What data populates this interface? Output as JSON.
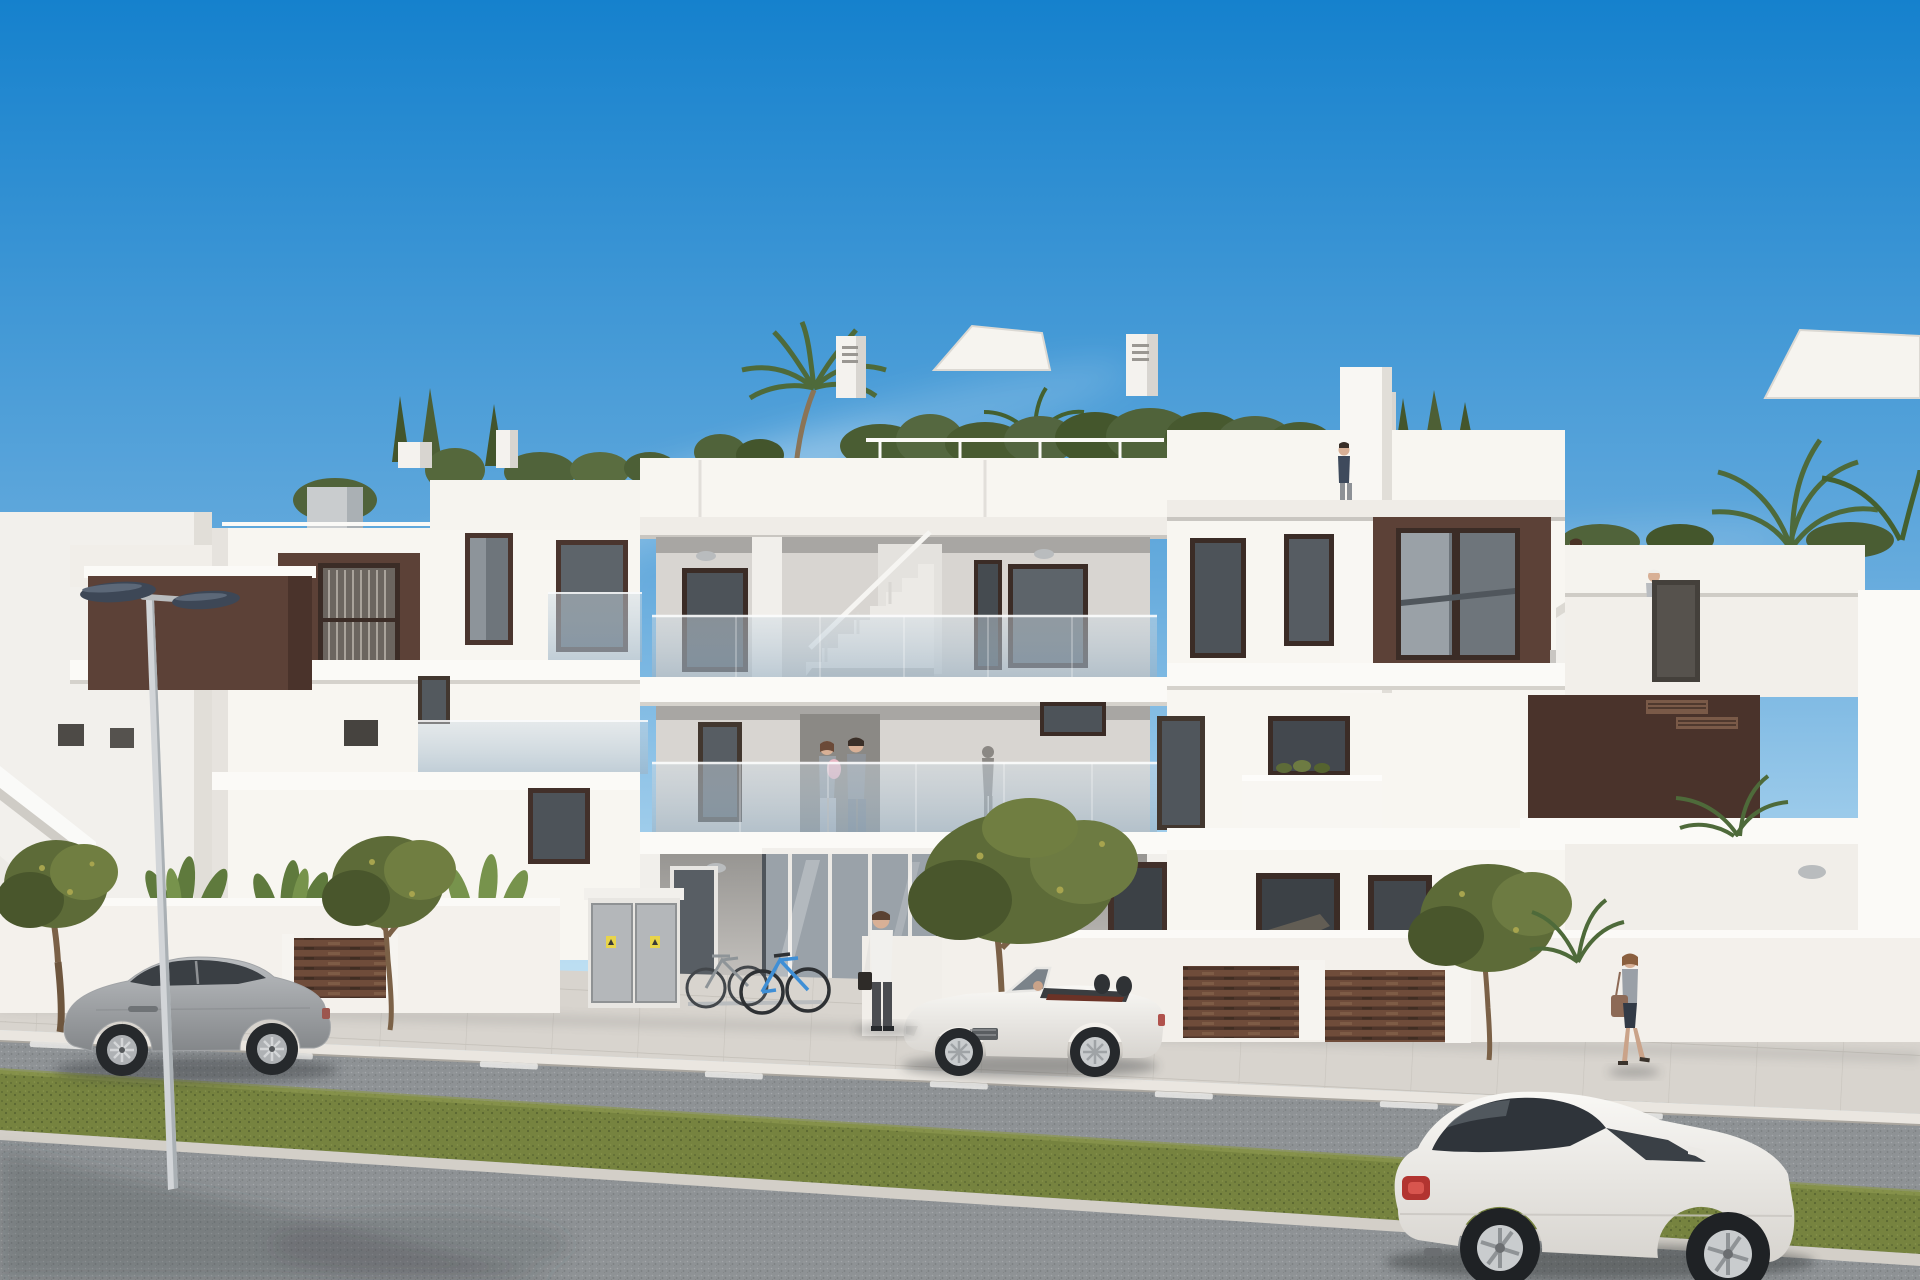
{
  "meta": {
    "type": "architectural-3d-render",
    "description": "Photorealistic CGI exterior of a modern flat-roofed white apartment building with dark brown accent panels, frameless glass balconies and roof terraces with plants, seen from the street on a sunny day",
    "time_of_day": "midday",
    "weather": "clear blue sky with thin wispy clouds"
  },
  "colors": {
    "sky_top": "#1581cd",
    "sky_mid": "#66abdd",
    "sky_low": "#c3e2f4",
    "sky_horizon": "#e6f3fa",
    "facade_white": "#f8f6f1",
    "facade_bright": "#fbfaf7",
    "facade_shade": "#e9e6e1",
    "recess_grey": "#d8d5d1",
    "recess_shadow": "#a8a6a3",
    "accent_brown": "#5c4137",
    "accent_brown_dark": "#4a332b",
    "window_frame": "#3b2c26",
    "window_glass": "#6e757b",
    "window_glass_dark": "#43484e",
    "balustrade_glass": "#9db4c6",
    "balustrade_glass_light": "#cfdbe4",
    "fence_brown": "#6f4c3a",
    "fence_gap": "#4e352a",
    "sidewalk": "#d8d4ce",
    "kerb": "#eae6e0",
    "asphalt": "#8e9295",
    "road_marking": "#ececea",
    "grass": "#76833f",
    "tree_olive": "#5d6b38",
    "palm_green": "#4e6a3a",
    "trunk_brown": "#7b6147",
    "lamp_head": "#3d4756",
    "car_grey": "#a0a3a6",
    "car_white": "#f3f2ef",
    "taillight_red": "#b23430",
    "warning_yellow": "#e8d44a",
    "bike_blue": "#3f8fd6"
  },
  "scene": {
    "building": {
      "floors": 3,
      "style": "modern Mediterranean new-build apartments",
      "features": [
        "white rendered facades",
        "dark chocolate-brown accent panels",
        "frameless tinted-glass balcony balustrades",
        "central open staircase between floors",
        "roof terraces with hedges, conifers and palms",
        "white parapets and chimney stacks",
        "brown horizontal-slat driveway gates",
        "glazed entrance lobby with bike rack and utility cabinets"
      ]
    },
    "vehicles": [
      {
        "name": "grey-sports-coupe",
        "color_key": "car_grey",
        "location": "parked at left kerb, side view facing left"
      },
      {
        "name": "white-convertible-roadster",
        "color_key": "car_white",
        "location": "parked on road in front of entrance, top down"
      },
      {
        "name": "white-compact-coupe",
        "color_key": "car_white",
        "location": "foreground lower right, rear three-quarter view"
      }
    ],
    "people": [
      {
        "name": "woman-with-baby",
        "location": "first-floor balcony behind glass"
      },
      {
        "name": "man-beside-woman",
        "location": "first-floor balcony behind glass"
      },
      {
        "name": "man-white-shirt-briefcase",
        "location": "standing at entrance walkway"
      },
      {
        "name": "woman-climbing-stairs",
        "location": "external stair to roof terrace, right"
      },
      {
        "name": "woman-on-roof-terrace",
        "location": "far right roof terrace behind parapet"
      },
      {
        "name": "man-on-tower-terrace",
        "location": "small terrace beside stair tower"
      },
      {
        "name": "woman-walking-handbag",
        "location": "right sidewalk walking right"
      }
    ],
    "vegetation": [
      "roof hedge and conifers along parapet",
      "two roof palms and background palm clusters",
      "four young olive-green street trees",
      "banana plants behind left garden wall",
      "white shade sails on roof terraces"
    ],
    "street_furniture": [
      "double-headed street lamp",
      "bike rack with blue and grey bicycles",
      "grey utility cabinets with yellow warning labels",
      "brown slatted gates and white garden walls",
      "asphalt road with dashed centre line and grass verge strip"
    ]
  }
}
